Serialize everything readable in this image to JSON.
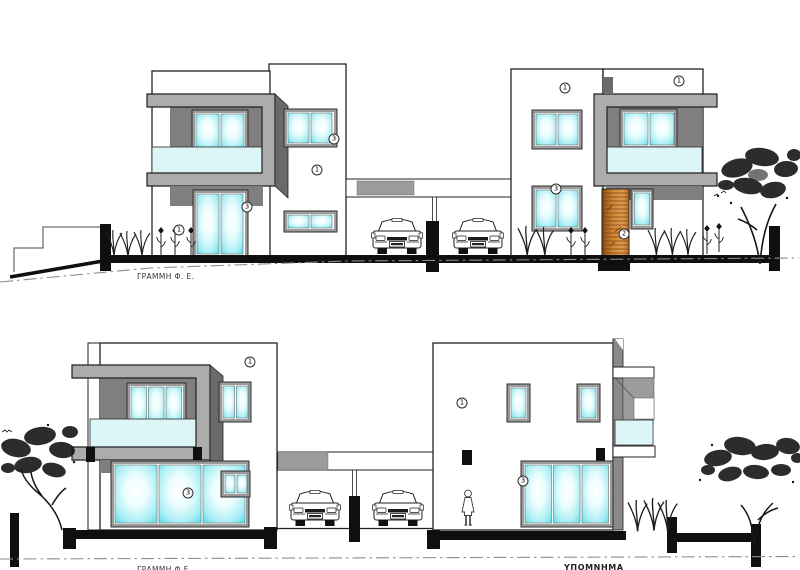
{
  "drawing": {
    "labels": {
      "ground_line_top": "ΓΡΑΜΜΗ Φ. Ε.",
      "ground_line_bottom": "ΓΡΑΜΜΗ Φ.Ε.",
      "legend": "ΥΠΟΜΝΗΜΑ"
    },
    "material_badges": [
      {
        "num": "3",
        "x": 334,
        "y": 139
      },
      {
        "num": "1",
        "x": 317,
        "y": 170
      },
      {
        "num": "3",
        "x": 247,
        "y": 207
      },
      {
        "num": "1",
        "x": 179,
        "y": 230
      },
      {
        "num": "1",
        "x": 565,
        "y": 88
      },
      {
        "num": "1",
        "x": 679,
        "y": 81
      },
      {
        "num": "3",
        "x": 556,
        "y": 189
      },
      {
        "num": "2",
        "x": 624,
        "y": 234
      },
      {
        "num": "1",
        "x": 250,
        "y": 362
      },
      {
        "num": "3",
        "x": 188,
        "y": 493
      },
      {
        "num": "1",
        "x": 462,
        "y": 403
      },
      {
        "num": "3",
        "x": 523,
        "y": 481
      }
    ],
    "colors": {
      "glass_edge": "#4bd8e5",
      "glass_center": "#ffffff",
      "railing_glass": "#def6f7",
      "band_light_gray": "#acacac",
      "band_side_dark": "#6a6a6a",
      "recess_gray": "#7f7f7f",
      "wood_door": "#ce8433",
      "outline": "#1c1c1c",
      "ground_black": "#0f0f0f"
    }
  }
}
